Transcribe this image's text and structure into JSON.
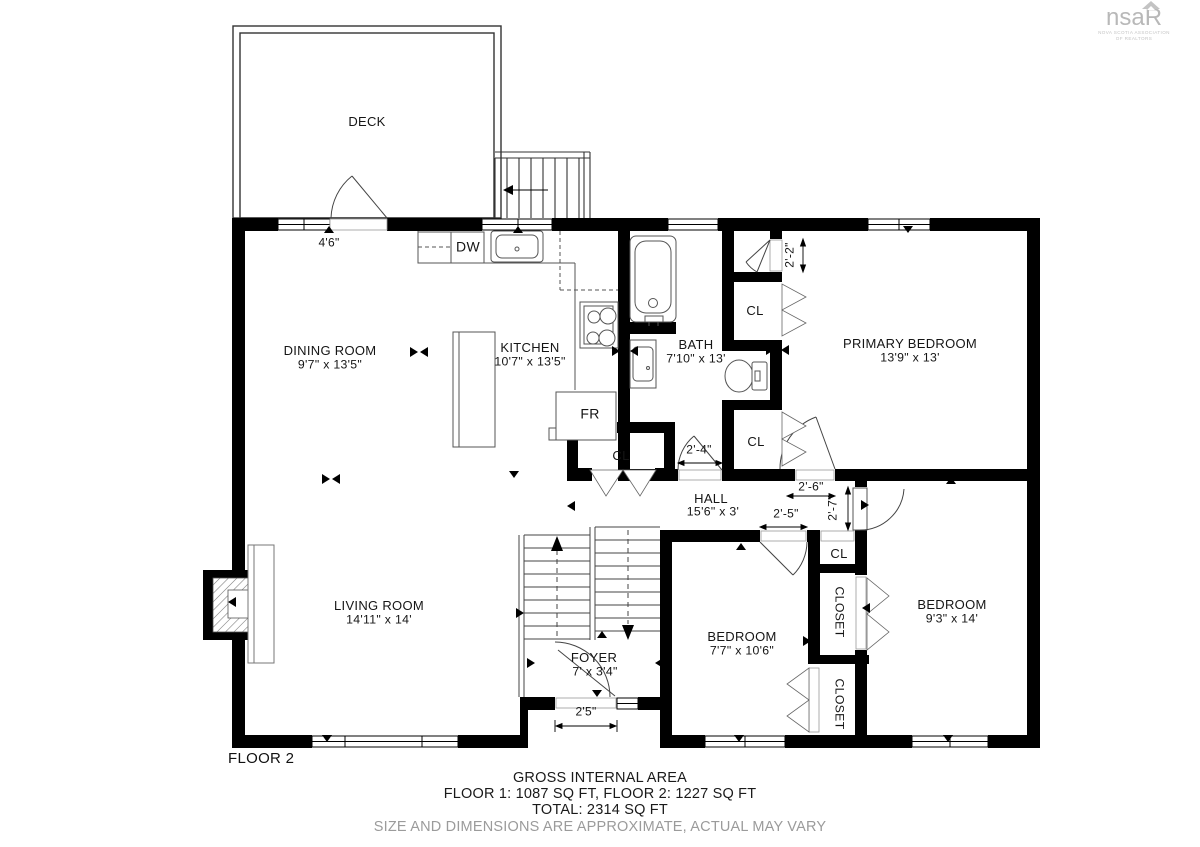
{
  "logo": {
    "text_ns": "ns",
    "text_a": "a",
    "text_r": "R",
    "tagline1": "NOVA SCOTIA ASSOCIATION",
    "tagline2": "OF REALTORS"
  },
  "floor_label": "FLOOR 2",
  "rooms": {
    "deck": {
      "name": "DECK",
      "dims": ""
    },
    "dining": {
      "name": "DINING ROOM",
      "dims": "9'7\" x 13'5\""
    },
    "kitchen": {
      "name": "KITCHEN",
      "dims": "10'7\" x 13'5\""
    },
    "bath": {
      "name": "BATH",
      "dims": "7'10\" x 13'"
    },
    "primary": {
      "name": "PRIMARY BEDROOM",
      "dims": "13'9\" x 13'"
    },
    "hall": {
      "name": "HALL",
      "dims": "15'6\" x 3'"
    },
    "living": {
      "name": "LIVING ROOM",
      "dims": "14'11\" x 14'"
    },
    "foyer": {
      "name": "FOYER",
      "dims": "7' x 3'4\""
    },
    "bedroom1": {
      "name": "BEDROOM",
      "dims": "7'7\" x 10'6\""
    },
    "bedroom2": {
      "name": "BEDROOM",
      "dims": "9'3\" x 14'"
    }
  },
  "fixtures": {
    "dishwasher": "DW",
    "fridge": "FR"
  },
  "closets": {
    "bath_upper": "CL",
    "bath_lower": "CL",
    "hall_closet": "CL",
    "linen": "CL",
    "closet1": "CLOSET",
    "closet2": "CLOSET"
  },
  "dimensions": {
    "deck_door": "4'6\"",
    "primary_nook": "2'-2\"",
    "bath_door": "2'-4\"",
    "primary_door": "2'-6\"",
    "bedroom1_door": "2'-5\"",
    "bedroom2_door": "2'-7\"",
    "entry_door": "2'5\""
  },
  "footer": {
    "line1": "GROSS INTERNAL AREA",
    "line2": "FLOOR 1: 1087 SQ FT, FLOOR 2: 1227 SQ FT",
    "line3": "TOTAL: 2314 SQ FT",
    "line4": "SIZE AND DIMENSIONS ARE APPROXIMATE, ACTUAL MAY VARY"
  },
  "colors": {
    "wall": "#000000",
    "fixture_line": "#555555",
    "muted_text": "#9b9b9b",
    "logo": "#b8b8b8"
  }
}
